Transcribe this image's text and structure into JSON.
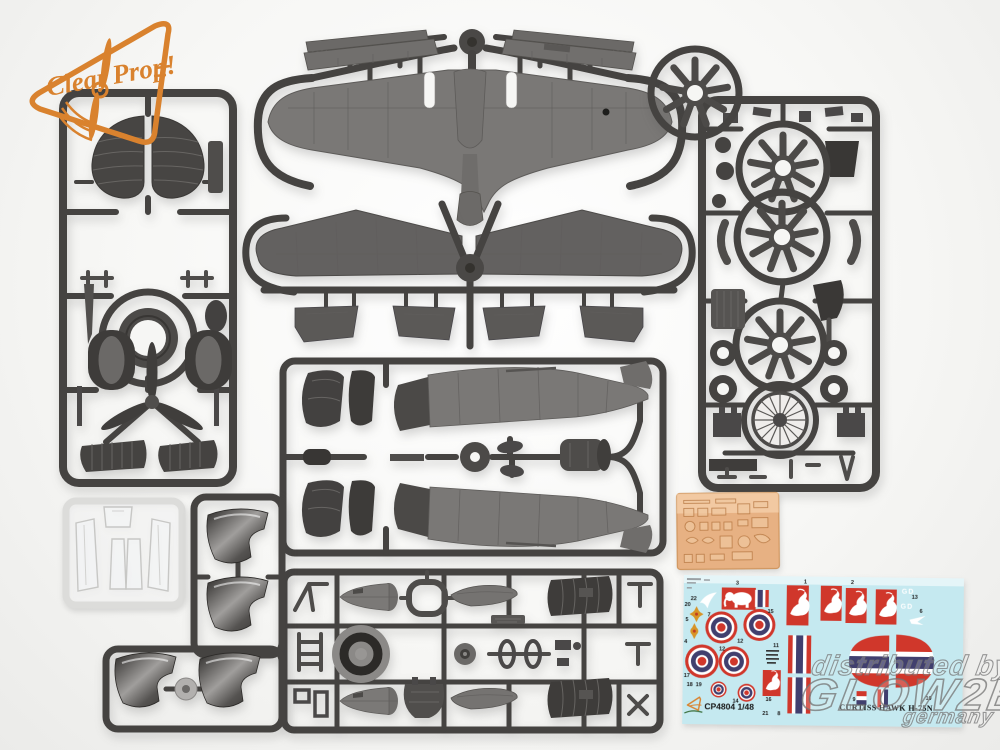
{
  "logo": {
    "word1": "Clear",
    "word2": "Prop!",
    "color": "#d9822e"
  },
  "watermark": {
    "line1": "distributed by",
    "line2": "GLOW2B",
    "line3": "germany"
  },
  "decal_sheet": {
    "kit_code": "CP4804 1/48",
    "title": "CURTISS HAWK H-75N",
    "brand": "Clear Prop!",
    "fuselage_code": "GD",
    "colors": {
      "background": "#c5e9f0",
      "red": "#d0372b",
      "blue": "#413f6e",
      "gold": "#d79427",
      "white": "#ffffff"
    },
    "part_numbers": [
      {
        "n": "22",
        "x": 7,
        "y": 25
      },
      {
        "n": "20",
        "x": 1,
        "y": 31
      },
      {
        "n": "7",
        "x": 24,
        "y": 41
      },
      {
        "n": "5",
        "x": 2,
        "y": 46
      },
      {
        "n": "4",
        "x": 1,
        "y": 68
      },
      {
        "n": "3",
        "x": 52,
        "y": 9
      },
      {
        "n": "15",
        "x": 84,
        "y": 37
      },
      {
        "n": "12",
        "x": 54,
        "y": 67
      },
      {
        "n": "11",
        "x": 90,
        "y": 71
      },
      {
        "n": "12",
        "x": 36,
        "y": 75
      },
      {
        "n": "17",
        "x": 1,
        "y": 102
      },
      {
        "n": "18",
        "x": 4,
        "y": 111
      },
      {
        "n": "19",
        "x": 13,
        "y": 111
      },
      {
        "n": "14",
        "x": 50,
        "y": 127
      },
      {
        "n": "16",
        "x": 83,
        "y": 125
      },
      {
        "n": "21",
        "x": 80,
        "y": 139
      },
      {
        "n": "8",
        "x": 95,
        "y": 139
      },
      {
        "n": "1",
        "x": 120,
        "y": 7
      },
      {
        "n": "2",
        "x": 167,
        "y": 7
      },
      {
        "n": "13",
        "x": 228,
        "y": 21
      },
      {
        "n": "6",
        "x": 236,
        "y": 35
      },
      {
        "n": "9",
        "x": 170,
        "y": 124
      },
      {
        "n": "10",
        "x": 243,
        "y": 122
      }
    ]
  },
  "photo_etch_fret": {
    "color": "#e7b183"
  },
  "plastic": {
    "runner_color": "#454341",
    "part_color": "#716f6d",
    "dark_part_color": "#3a3836"
  },
  "clear_parts": {
    "tint": "#eef1f3"
  }
}
